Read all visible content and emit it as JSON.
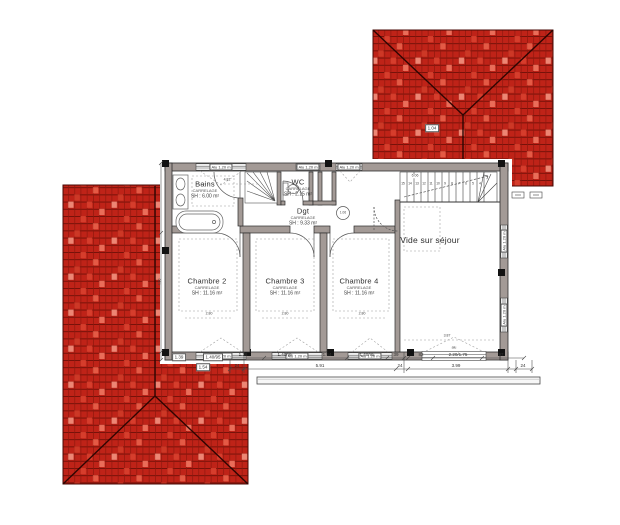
{
  "rooms": {
    "bains": {
      "name": "Bains",
      "finish": "CARRELAGE",
      "area": "SH : 6.00 m²"
    },
    "wc": {
      "name": "WC",
      "finish": "CARRELAGE",
      "area": "SH : 2.15 m²"
    },
    "dgt": {
      "name": "Dgt",
      "finish": "CARRELAGE",
      "area": "SH : 9.33 m²"
    },
    "chambre2": {
      "name": "Chambre 2",
      "finish": "CARRELAGE",
      "area": "SH : 11.16 m²"
    },
    "chambre3": {
      "name": "Chambre 3",
      "finish": "CARRELAGE",
      "area": "SH : 11.16 m²"
    },
    "chambre4": {
      "name": "Chambre 4",
      "finish": "CARRELAGE",
      "area": "SH : 11.16 m²"
    },
    "vide": {
      "name": "Vide sur séjour"
    }
  },
  "window_label": "Alu 1.20 m",
  "dims": {
    "bottom_row1": [
      "1.18",
      "1.40/95",
      "1.54",
      "1.40/95",
      "39"
    ],
    "bottom_row1_right": [
      "82",
      "2.20/1.75",
      "97"
    ],
    "bottom_row2": [
      "24",
      "5.91",
      "24",
      "3.99",
      "24"
    ],
    "roof_boxes": [
      "1.39",
      "1.40/95",
      "1.54"
    ],
    "room_width": "2.80",
    "vide_width": "3.87",
    "bains_width": "4.81",
    "stair_length": "6.06",
    "left_height": "4.50",
    "roof_mark": "1.04",
    "level_mark": "1.06",
    "alu_note": "alu"
  },
  "stairs": {
    "steps": [
      "15",
      "14",
      "13",
      "12",
      "11",
      "10",
      "9",
      "8",
      "7",
      "6",
      "5",
      "4"
    ]
  },
  "colors": {
    "roof_tile": "#bf2318",
    "roof_tile_light": "#e8604a",
    "roof_joint": "#701008",
    "roof_ridge": "#2e0502",
    "wall_fill": "#a39a96",
    "line": "#3b3b3b"
  }
}
